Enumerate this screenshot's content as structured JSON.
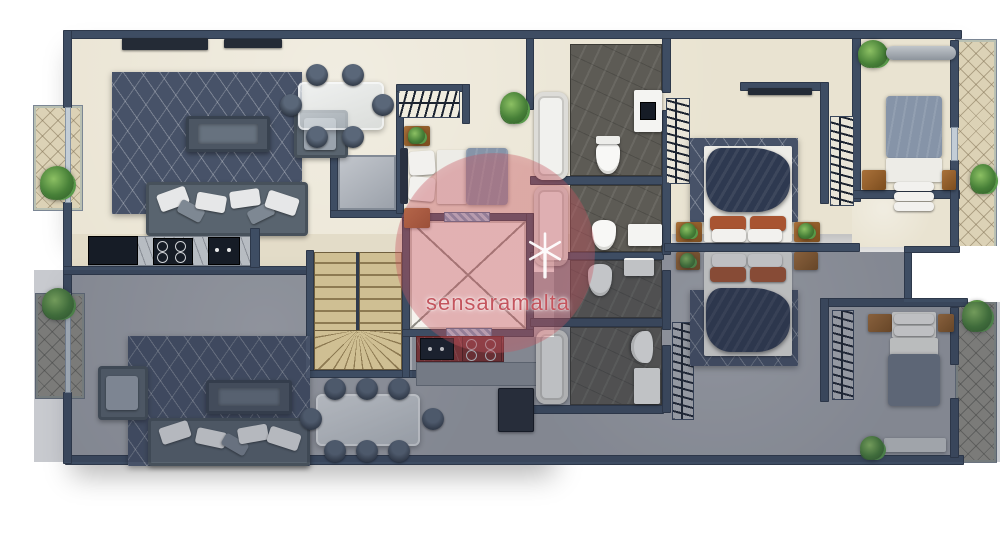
{
  "watermark": {
    "text": "sensaramalta",
    "icon": "windmill-icon",
    "color": "#c4555e"
  },
  "plan": {
    "type": "residential-floor-plan",
    "units": [
      {
        "id": "upper-apartment",
        "floor_finish": "cream",
        "rooms": [
          "living-room",
          "dining-area",
          "kitchen",
          "bedroom-2",
          "bathroom-1",
          "bathroom-2",
          "master-bedroom",
          "walk-in-wardrobes",
          "bedroom-3",
          "terrace",
          "balcony"
        ]
      },
      {
        "id": "lower-apartment",
        "floor_finish": "gray-shaded",
        "rooms": [
          "living-room",
          "dining-area",
          "kitchen",
          "bathroom-1",
          "bathroom-2",
          "wardrobe",
          "master-bedroom",
          "bedroom-2",
          "terrace",
          "balcony"
        ]
      }
    ],
    "core": [
      "staircase",
      "lift-shaft",
      "service-duct"
    ],
    "furniture": [
      "sofa",
      "armchair",
      "coffee-table",
      "dining-table",
      "chairs",
      "double-bed",
      "single-bed",
      "nightstand",
      "wardrobe-rail",
      "bathtub",
      "toilet",
      "vanity",
      "stove",
      "sink",
      "fridge",
      "ac-unit",
      "tv-console",
      "bench",
      "plants"
    ]
  },
  "palette": {
    "wall": "#3e4d63",
    "floor_upper": "#e9e3d1",
    "floor_lower": "#a2a5ac",
    "terrace_tile_cream": "#dcd2b6",
    "terrace_tile_gray": "#97958c",
    "bathroom_tile": "#5d5b55",
    "rug": "#475268",
    "stair": "#cfbf93",
    "lift_door": "#8fb8d8",
    "duvet_dark": "#2e3950",
    "duvet_blue": "#8694a8",
    "pillow_accent": "#a85431",
    "wood": "#96652e",
    "plant": "#478038",
    "counter_red": "#8d3434",
    "watermark_red": "#c4555e"
  }
}
